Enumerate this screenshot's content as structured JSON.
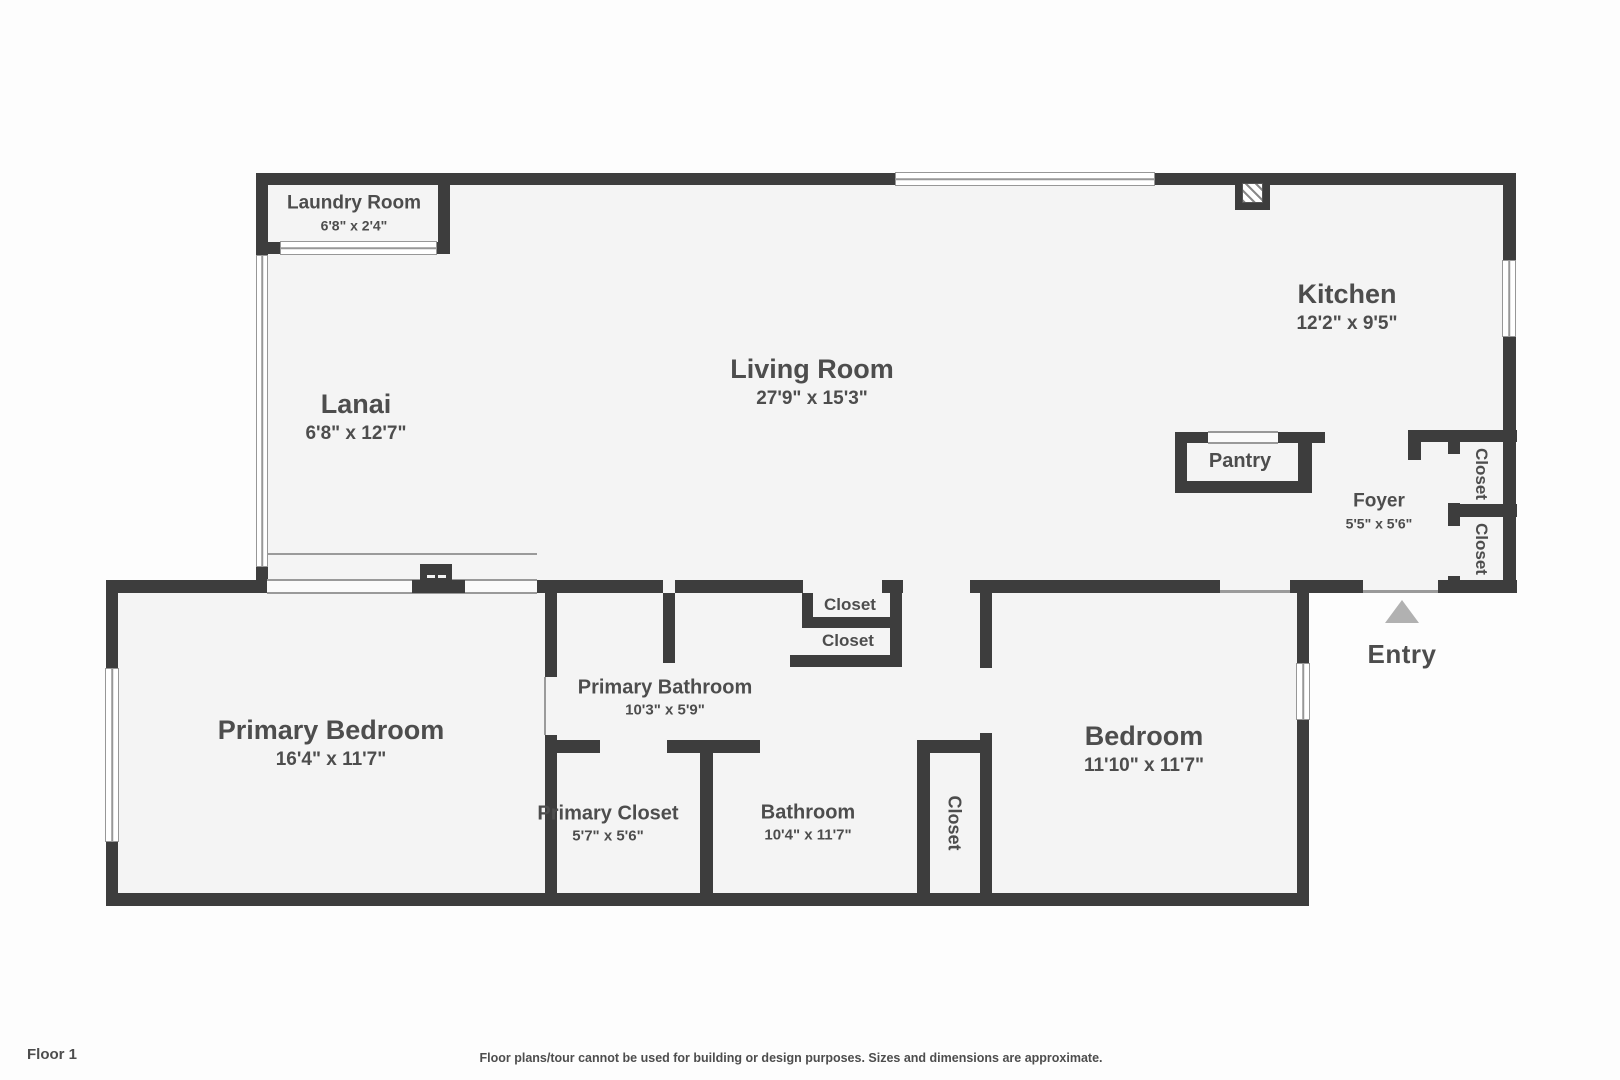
{
  "meta": {
    "floor_label": "Floor 1",
    "disclaimer": "Floor plans/tour cannot be used for building or design purposes. Sizes and dimensions are approximate."
  },
  "colors": {
    "wall": "#3d3d3d",
    "floor": "#f4f4f4",
    "text": "#4d4d4d",
    "window_line": "#979797",
    "entry_arrow": "#b1b1b1"
  },
  "rooms": {
    "laundry": {
      "name": "Laundry Room",
      "dims": "6'8\" x 2'4\""
    },
    "lanai": {
      "name": "Lanai",
      "dims": "6'8\" x 12'7\""
    },
    "living": {
      "name": "Living Room",
      "dims": "27'9\" x 15'3\""
    },
    "kitchen": {
      "name": "Kitchen",
      "dims": "12'2\" x 9'5\""
    },
    "pantry": {
      "name": "Pantry"
    },
    "foyer": {
      "name": "Foyer",
      "dims": "5'5\" x 5'6\""
    },
    "foyer_closet_upper": {
      "name": "Closet"
    },
    "foyer_closet_lower": {
      "name": "Closet"
    },
    "primary_bedroom": {
      "name": "Primary Bedroom",
      "dims": "16'4\" x 11'7\""
    },
    "primary_bathroom": {
      "name": "Primary Bathroom",
      "dims": "10'3\" x 5'9\""
    },
    "hall_closet_upper": {
      "name": "Closet"
    },
    "hall_closet_lower": {
      "name": "Closet"
    },
    "primary_closet": {
      "name": "Primary Closet",
      "dims": "5'7\" x 5'6\""
    },
    "bathroom": {
      "name": "Bathroom",
      "dims": "10'4\" x 11'7\""
    },
    "bedroom_closet": {
      "name": "Closet"
    },
    "bedroom": {
      "name": "Bedroom",
      "dims": "11'10\" x 11'7\""
    },
    "entry": {
      "name": "Entry"
    }
  }
}
